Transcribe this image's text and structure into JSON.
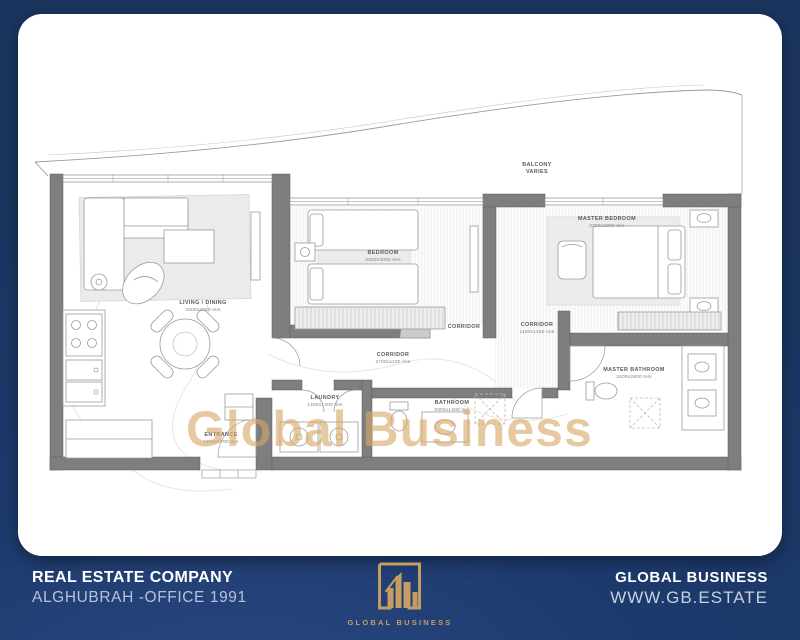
{
  "colors": {
    "navy": "#1d3a6d",
    "gold": "#c59d63",
    "watermark": "#d9a968",
    "wall": "#7e7e7e"
  },
  "watermark": "Global Business",
  "plan": {
    "rooms": [
      {
        "name": "BALCONY",
        "dims": "VARIES"
      },
      {
        "name": "LIVING / DINING",
        "dims": "3400x4000 mm"
      },
      {
        "name": "BEDROOM",
        "dims": "3400x3000 mm"
      },
      {
        "name": "MASTER BEDROOM",
        "dims": "2300x2000 mm"
      },
      {
        "name": "CORRIDOR",
        "dims": "2700x1100 mm"
      },
      {
        "name": "CORRIDOR",
        "dims": ""
      },
      {
        "name": "CORRIDOR",
        "dims": "1100x1400 mm"
      },
      {
        "name": "LAUNDRY",
        "dims": "1400x1400 mm"
      },
      {
        "name": "BATHROOM",
        "dims": "3300x1400 mm"
      },
      {
        "name": "MASTER BATHROOM",
        "dims": "2400x2800 mm"
      },
      {
        "name": "ENTRANCE",
        "dims": "1300x1700 mm"
      }
    ]
  },
  "footer": {
    "company_label": "REAL ESTATE COMPANY",
    "office": "ALGHUBRAH -OFFICE 1991",
    "brand": "GLOBAL BUSINESS",
    "website": "WWW.GB.ESTATE",
    "logo_label": "GLOBAL BUSINESS"
  }
}
